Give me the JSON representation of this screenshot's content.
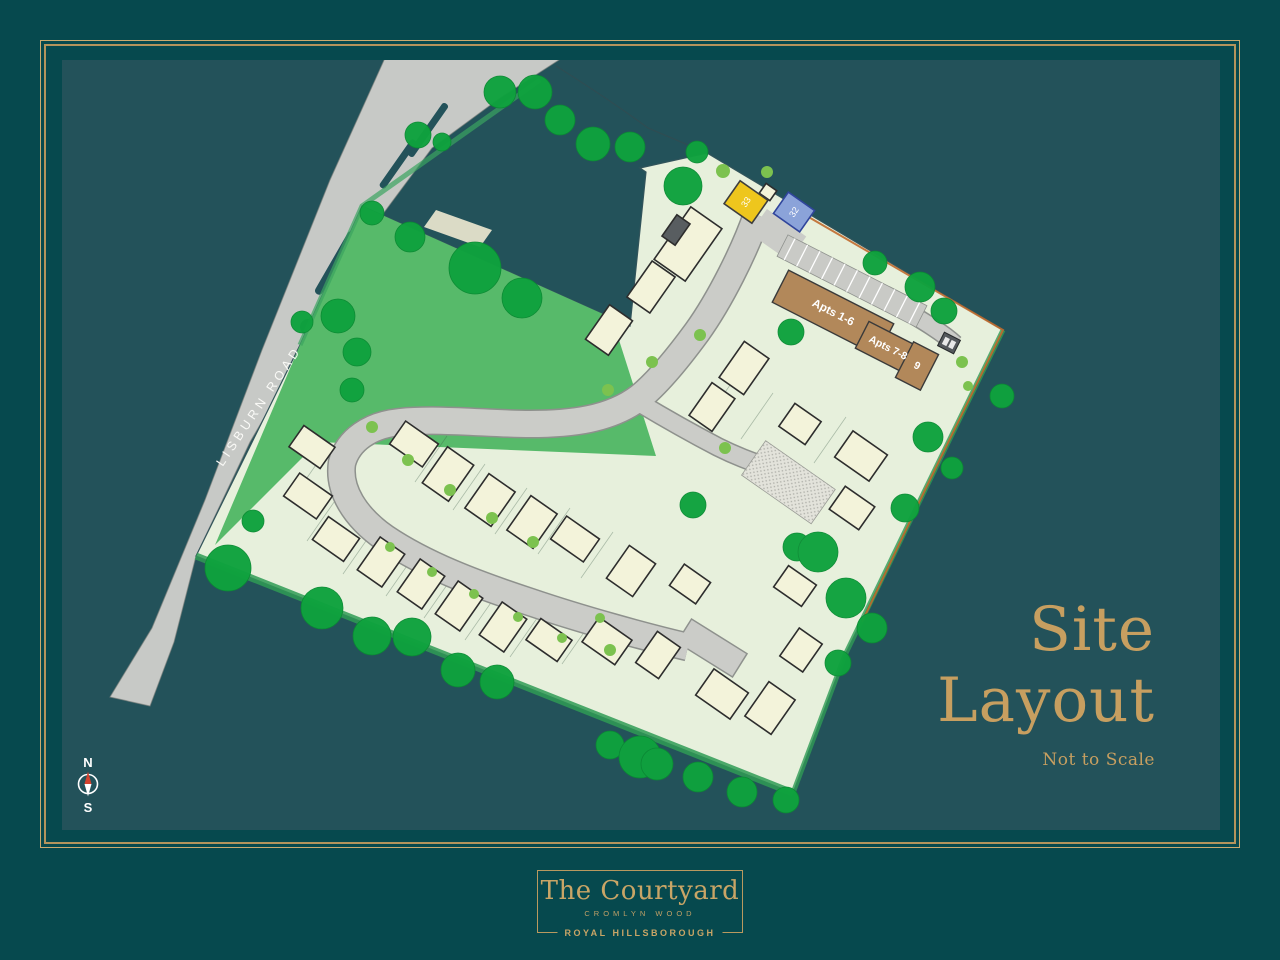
{
  "title": {
    "line1": "Site",
    "line2": "Layout",
    "note": "Not to Scale"
  },
  "map": {
    "road_label": "LISBURN ROAD",
    "apartments": [
      {
        "label": "Apts 1-6"
      },
      {
        "label": "Apts 7-8"
      },
      {
        "label": "9"
      }
    ],
    "plots": [
      {
        "number": "33",
        "color": "#EEC61D"
      },
      {
        "number": "32",
        "color": "#8BA3D9"
      }
    ],
    "compass": {
      "north": "N",
      "south": "S"
    }
  },
  "footer": {
    "name": "The Courtyard",
    "location": "CROMLYN WOOD",
    "town": "ROYAL HILLSBOROUGH"
  },
  "colors": {
    "background": "#06494E",
    "panel": "#23525A",
    "frame_gold": "#B3945C",
    "heading_gold": "#C79F60",
    "site_ground": "#E7F0DC",
    "field_green": "#57BA6A",
    "tree_green": "#0FA23E",
    "bush_green": "#7CC24F",
    "road_grey": "#CBCCC8",
    "house_cream": "#F3F3DA",
    "apartments_brown": "#B2885A",
    "boundary_orange": "#C06A2D",
    "compass_needle_red": "#D2422E"
  }
}
